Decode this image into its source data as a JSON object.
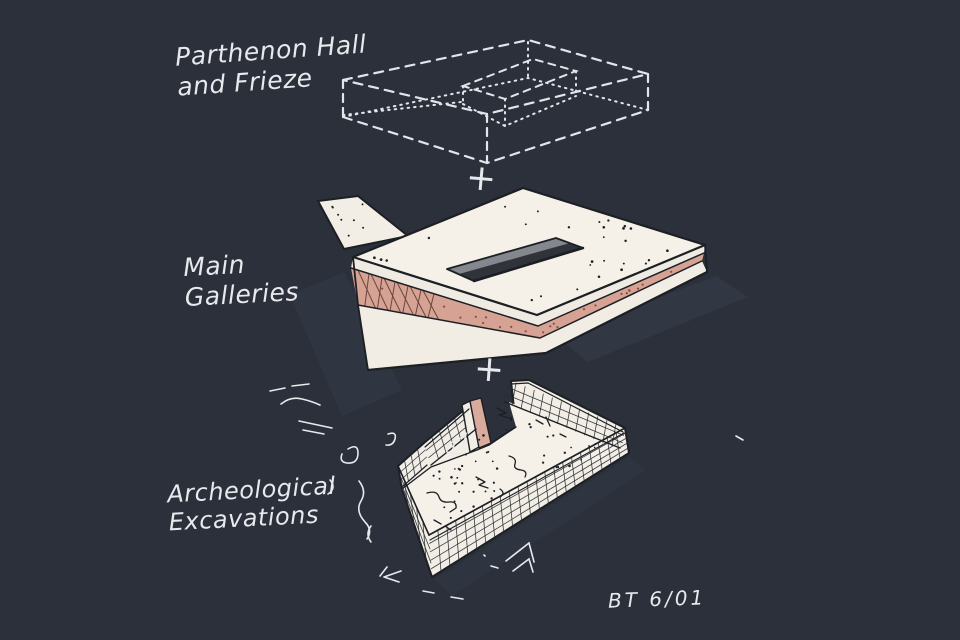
{
  "scene": {
    "background": "#2b303b",
    "chalk": "#e7e9ec",
    "ink": "#1c1f24",
    "paper_white": "#f4f0e7",
    "pink_layer": "#d5a294",
    "slot_light": "#84878d",
    "slot_dark": "#30333a"
  },
  "labels": {
    "parthenon": {
      "line1": "Parthenon Hall",
      "line2": "and Frieze"
    },
    "galleries": {
      "line1": "Main",
      "line2": "Galleries"
    },
    "excavations": {
      "line1": "Archeological",
      "line2": "Excavations"
    }
  },
  "plus_top": "+",
  "plus_bottom": "+",
  "signature": "BT 6/01"
}
